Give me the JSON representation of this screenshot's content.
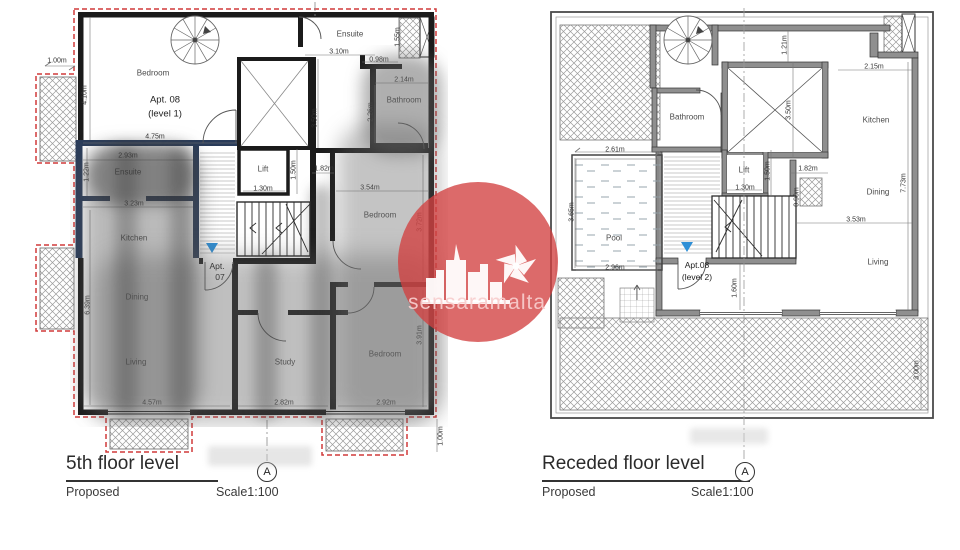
{
  "watermark": {
    "text": "sensaramalta"
  },
  "colors": {
    "boundary_dashed": "#d03a3a",
    "modified_walls_navy": "#2a3c5a",
    "level_marker_blue": "#2f8fd6",
    "watermark_red": "#d24040"
  },
  "left": {
    "title": "5th floor level",
    "proposed": "Proposed",
    "scale": "Scale1:100",
    "marker": "A",
    "apt08": "Apt. 08",
    "apt08_level": "(level 1)",
    "apt07_line1": "Apt.",
    "apt07_line2": "07",
    "rooms": {
      "bedroom_tl": "Bedroom",
      "ensuite_top": "Ensuite",
      "bathroom": "Bathroom",
      "lift": "Lift",
      "ensuite_left": "Ensuite",
      "kitchen": "Kitchen",
      "dining": "Dining",
      "living": "Living",
      "study": "Study",
      "bedroom_mid": "Bedroom",
      "bedroom_br": "Bedroom"
    },
    "dims": {
      "d100_tl": "1.00m",
      "d410": "4.10m",
      "d475": "4.75m",
      "d293": "2.93m",
      "d122": "1.22m",
      "d323": "3.23m",
      "d639": "6.39m",
      "d457": "4.57m",
      "d310": "3.10m",
      "d098": "0.98m",
      "d155": "1.55m",
      "d214": "2.14m",
      "d226": "2.26m",
      "d350": "3.50m",
      "d150": "1.50m",
      "d130": "1.30m",
      "d182": "1.82m",
      "d354": "3.54m",
      "d372": "3.72m",
      "d391": "3.91m",
      "d282": "2.82m",
      "d292": "2.92m",
      "d100_br": "1.00m"
    }
  },
  "right": {
    "title": "Receded floor level",
    "proposed": "Proposed",
    "scale": "Scale1:100",
    "marker": "A",
    "apt08_line1": "Apt.08",
    "apt08_line2": "(level 2)",
    "rooms": {
      "bathroom": "Bathroom",
      "kitchen": "Kitchen",
      "dining": "Dining",
      "living": "Living",
      "lift": "Lift",
      "pool": "Pool"
    },
    "dims": {
      "d121": "1.21m",
      "d215": "2.15m",
      "d350": "3.50m",
      "d150": "1.50m",
      "d130": "1.30m",
      "d182": "1.82m",
      "d090": "0.90m",
      "d261": "2.61m",
      "d365": "3.65m",
      "d296": "2.96m",
      "d160": "1.60m",
      "d353": "3.53m",
      "d773": "7.73m",
      "d300": "3.00m"
    }
  }
}
